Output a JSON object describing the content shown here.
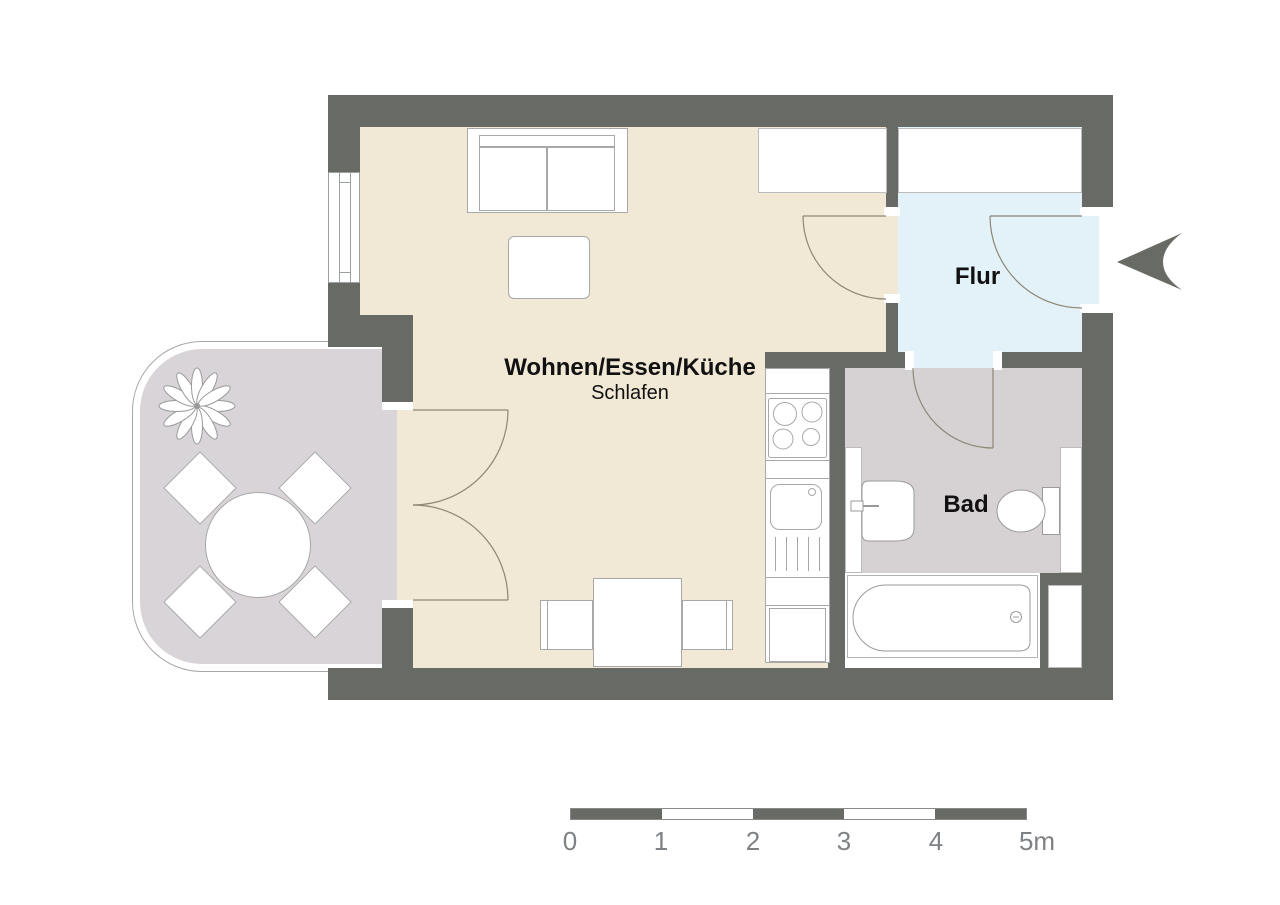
{
  "document": {
    "type": "apartment-floor-plan"
  },
  "rooms": {
    "living": {
      "label": "Wohnen/Essen/Küche",
      "sublabel": "Schlafen"
    },
    "hall": {
      "label": "Flur"
    },
    "bath": {
      "label": "Bad"
    }
  },
  "scale_bar": {
    "labels": [
      "0",
      "1",
      "2",
      "3",
      "4",
      "5m"
    ],
    "unit": "m",
    "meters": 5
  },
  "colors": {
    "wall": "#686b65",
    "floor_living": "#f2e8d6",
    "floor_hall": "#e3f1f9",
    "floor_bath": "#d6d2d3",
    "floor_balcony": "#d8d4d7",
    "fixture_outline": "#a0a0a0",
    "door_arc": "#8d8775",
    "scale_text": "#7f8285",
    "label_text": "#111111"
  },
  "furniture_icons": [
    "sofa",
    "coffee-table",
    "dining-table",
    "dining-chair",
    "wardrobe",
    "kitchen-counter",
    "stove",
    "kitchen-sink",
    "washbasin",
    "toilet",
    "bathtub",
    "shelf",
    "balcony-table",
    "balcony-chair",
    "plant",
    "entrance-arrow",
    "window"
  ]
}
